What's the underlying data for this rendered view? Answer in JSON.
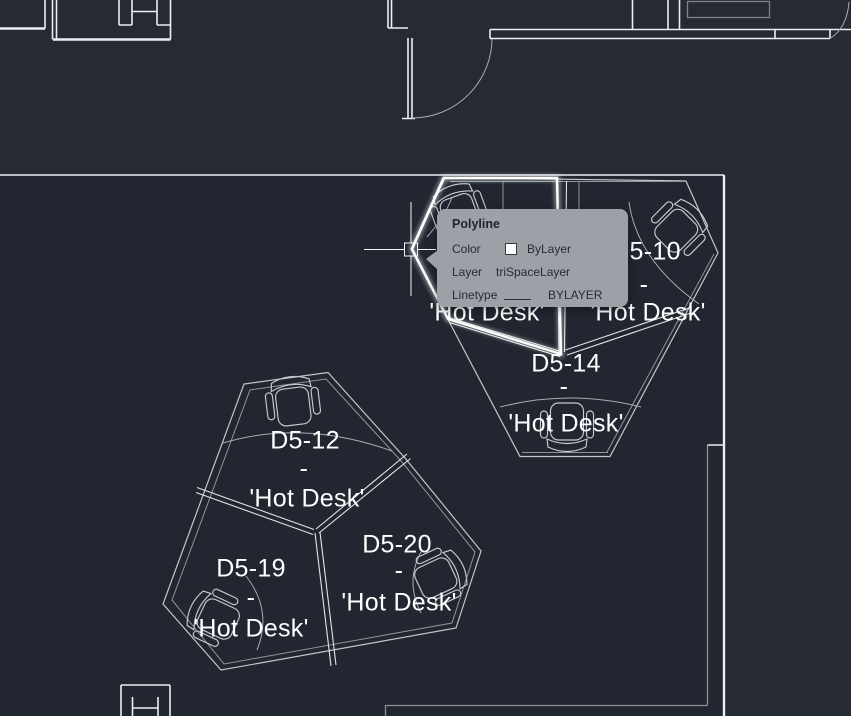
{
  "theme": {
    "bg-exterior": "#262b33",
    "bg-interior": "#212630",
    "wall-line": "#eceef1",
    "pod-line": "#c2c7cd",
    "divider-line": "#e2e5e9",
    "detail-line": "#a6adb4",
    "dim-line": "#7b8289",
    "highlight-line": "#ffffff",
    "label-color": "#ffffff",
    "tooltip-bg": "#9ba1a7",
    "tooltip-text": "#272d35",
    "crosshair-color": "#f5f6f8"
  },
  "tooltip": {
    "title": "Polyline",
    "rows": {
      "color": {
        "label": "Color",
        "value": "ByLayer"
      },
      "layer": {
        "label": "Layer",
        "value": "triSpaceLayer"
      },
      "linetype": {
        "label": "Linetype",
        "value": "BYLAYER"
      }
    }
  },
  "desks": {
    "hidden_upper_left": {
      "type_label": "'Hot Desk'"
    },
    "d5_10": {
      "id": "D5-10",
      "separator": "-",
      "type_label": "'Hot Desk'"
    },
    "d5_14": {
      "id": "D5-14",
      "separator": "-",
      "type_label": "'Hot Desk'"
    },
    "d5_12": {
      "id": "D5-12",
      "separator": "-",
      "type_label": "'Hot Desk'"
    },
    "d5_19": {
      "id": "D5-19",
      "separator": "-",
      "type_label": "'Hot Desk'"
    },
    "d5_20": {
      "id": "D5-20",
      "separator": "-",
      "type_label": "'Hot Desk'"
    }
  }
}
